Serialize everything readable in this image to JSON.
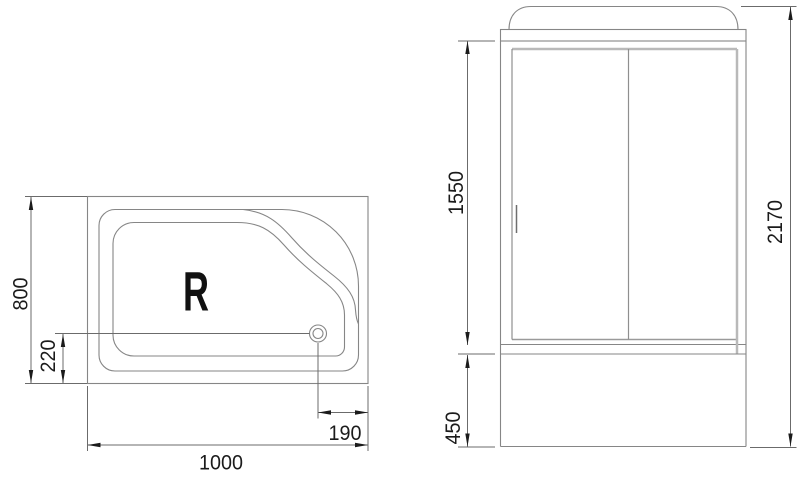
{
  "colors": {
    "background": "#ffffff",
    "outline": "#868686",
    "light_outline": "#b9b9b9",
    "dimension_line": "#6b6b6b",
    "text": "#1b1b1b"
  },
  "tray_top_view": {
    "orientation_label": "R",
    "dims": {
      "width": "1000",
      "depth": "800",
      "drain_bottom": "220",
      "drain_right": "190"
    }
  },
  "cabin_front_view": {
    "dims": {
      "door_height": "1550",
      "total_height": "2170",
      "base_height": "450"
    }
  }
}
